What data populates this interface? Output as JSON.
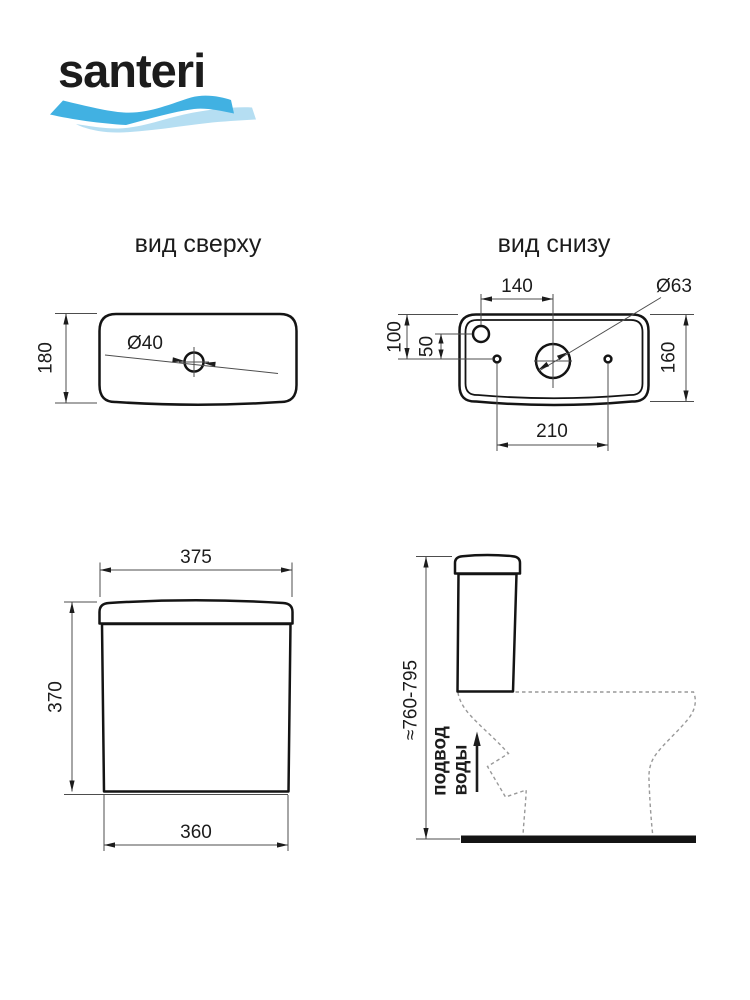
{
  "brand": {
    "name": "santeri",
    "navy": "#29246e",
    "wave_blue": "#41b1e2",
    "wave_light": "#b5def2"
  },
  "views": {
    "top": {
      "title": "вид сверху",
      "height_mm": "180",
      "button_diameter": "Ø40"
    },
    "bottom": {
      "title": "вид снизу",
      "inlet_offset_mm": "140",
      "drain_diameter": "Ø63",
      "edge_to_bolts_mm": "100",
      "inlet_to_bolts_mm": "50",
      "depth_mm": "160",
      "bolt_spacing_mm": "210"
    },
    "front": {
      "lid_width_mm": "375",
      "height_mm": "370",
      "base_width_mm": "360"
    },
    "side": {
      "install_height_mm": "≈760-795",
      "water_supply_line1": "подвод",
      "water_supply_line2": "воды"
    }
  }
}
